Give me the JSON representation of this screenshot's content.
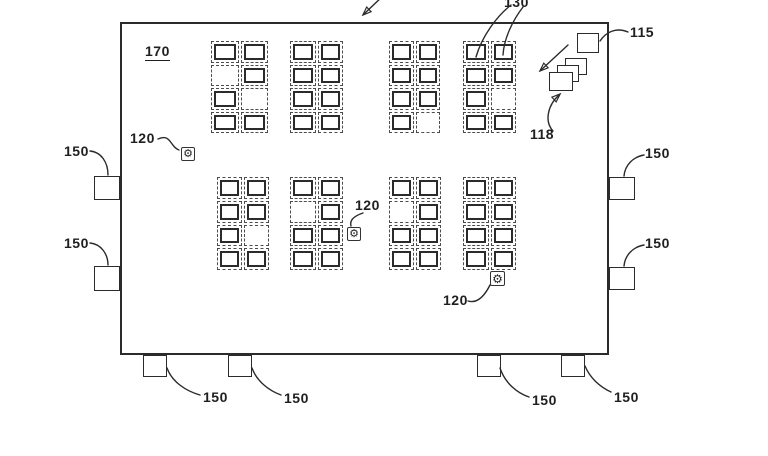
{
  "figure": {
    "width": 768,
    "height": 456,
    "bg": "#ffffff",
    "ink": "#2b2b2b"
  },
  "facility": {
    "label": "170",
    "x": 120,
    "y": 22,
    "w": 489,
    "h": 333,
    "label_x": 145,
    "label_y": 44
  },
  "storage_blocks": [
    {
      "x": 210,
      "y": 40,
      "w": 59,
      "h": 94,
      "pattern": [
        [
          1,
          1
        ],
        [
          0,
          1
        ],
        [
          1,
          0
        ],
        [
          1,
          1
        ]
      ]
    },
    {
      "x": 289,
      "y": 40,
      "w": 55,
      "h": 94,
      "pattern": [
        [
          1,
          1
        ],
        [
          1,
          1
        ],
        [
          1,
          1
        ],
        [
          1,
          1
        ]
      ]
    },
    {
      "x": 388,
      "y": 40,
      "w": 53,
      "h": 94,
      "pattern": [
        [
          1,
          1
        ],
        [
          1,
          1
        ],
        [
          1,
          1
        ],
        [
          1,
          0
        ]
      ]
    },
    {
      "x": 462,
      "y": 40,
      "w": 55,
      "h": 94,
      "pattern": [
        [
          1,
          1
        ],
        [
          1,
          1
        ],
        [
          1,
          0
        ],
        [
          1,
          1
        ]
      ]
    },
    {
      "x": 216,
      "y": 176,
      "w": 54,
      "h": 95,
      "pattern": [
        [
          1,
          1
        ],
        [
          1,
          1
        ],
        [
          1,
          0
        ],
        [
          1,
          1
        ]
      ]
    },
    {
      "x": 289,
      "y": 176,
      "w": 55,
      "h": 95,
      "pattern": [
        [
          1,
          1
        ],
        [
          0,
          1
        ],
        [
          1,
          1
        ],
        [
          1,
          1
        ]
      ]
    },
    {
      "x": 388,
      "y": 176,
      "w": 54,
      "h": 95,
      "pattern": [
        [
          1,
          1
        ],
        [
          0,
          1
        ],
        [
          1,
          1
        ],
        [
          1,
          1
        ]
      ]
    },
    {
      "x": 462,
      "y": 176,
      "w": 55,
      "h": 95,
      "pattern": [
        [
          1,
          1
        ],
        [
          1,
          1
        ],
        [
          1,
          1
        ],
        [
          1,
          1
        ]
      ]
    }
  ],
  "robots": [
    {
      "x": 181,
      "y": 147,
      "size": 14
    },
    {
      "x": 347,
      "y": 227,
      "size": 14
    },
    {
      "x": 490,
      "y": 271,
      "size": 15
    }
  ],
  "robot_glyph": "⚙",
  "doors": [
    {
      "x": 94,
      "y": 176,
      "w": 26,
      "h": 24
    },
    {
      "x": 94,
      "y": 266,
      "w": 26,
      "h": 25
    },
    {
      "x": 609,
      "y": 177,
      "w": 26,
      "h": 23
    },
    {
      "x": 609,
      "y": 267,
      "w": 26,
      "h": 23
    },
    {
      "x": 143,
      "y": 355,
      "w": 24,
      "h": 22
    },
    {
      "x": 228,
      "y": 355,
      "w": 24,
      "h": 22
    },
    {
      "x": 477,
      "y": 355,
      "w": 24,
      "h": 22
    },
    {
      "x": 561,
      "y": 355,
      "w": 24,
      "h": 22
    }
  ],
  "workstation": {
    "x": 577,
    "y": 33,
    "w": 22,
    "h": 20
  },
  "container_stack": [
    {
      "x": 565,
      "y": 58,
      "w": 22,
      "h": 17
    },
    {
      "x": 557,
      "y": 65,
      "w": 22,
      "h": 17
    },
    {
      "x": 549,
      "y": 72,
      "w": 24,
      "h": 19
    }
  ],
  "ref_labels": [
    {
      "id": "130",
      "text": "130",
      "x": 504,
      "y": -5
    },
    {
      "id": "115",
      "text": "115",
      "x": 630,
      "y": 25
    },
    {
      "id": "118",
      "text": "118",
      "x": 530,
      "y": 127
    },
    {
      "id": "120-1",
      "text": "120",
      "x": 130,
      "y": 131
    },
    {
      "id": "120-2",
      "text": "120",
      "x": 355,
      "y": 198
    },
    {
      "id": "120-3",
      "text": "120",
      "x": 443,
      "y": 293
    },
    {
      "id": "150-left-1",
      "text": "150",
      "x": 64,
      "y": 144
    },
    {
      "id": "150-left-2",
      "text": "150",
      "x": 64,
      "y": 236
    },
    {
      "id": "150-right-1",
      "text": "150",
      "x": 645,
      "y": 146
    },
    {
      "id": "150-right-2",
      "text": "150",
      "x": 645,
      "y": 236
    },
    {
      "id": "150-bottom-1",
      "text": "150",
      "x": 203,
      "y": 390
    },
    {
      "id": "150-bottom-2",
      "text": "150",
      "x": 284,
      "y": 391
    },
    {
      "id": "150-bottom-3",
      "text": "150",
      "x": 532,
      "y": 393
    },
    {
      "id": "150-bottom-4",
      "text": "150",
      "x": 614,
      "y": 390
    }
  ],
  "leader_lines": [
    {
      "id": "leader-130-a",
      "d": "M511,5 C497,16 482,36 476,57"
    },
    {
      "id": "leader-130-b",
      "d": "M523,7 C513,20 504,38 503,55"
    },
    {
      "id": "leader-115",
      "d": "M628,32 C616,27 606,32 600,41"
    },
    {
      "id": "leader-120-1",
      "d": "M158,139 C171,133 170,147 179,150"
    },
    {
      "id": "leader-120-2",
      "d": "M363,213 C357,215 349,219 351,226"
    },
    {
      "id": "leader-120-3",
      "d": "M468,301 C478,304 485,295 490,285"
    },
    {
      "id": "leader-150-l1",
      "d": "M90,151 C101,152 108,162 108,175"
    },
    {
      "id": "leader-150-l2",
      "d": "M90,243 C101,244 108,254 108,265"
    },
    {
      "id": "leader-150-r1",
      "d": "M644,155 C633,157 625,165 624,176"
    },
    {
      "id": "leader-150-r2",
      "d": "M644,245 C633,247 625,255 624,266"
    },
    {
      "id": "leader-150-b1",
      "d": "M167,368 C172,382 186,391 200,395"
    },
    {
      "id": "leader-150-b2",
      "d": "M252,368 C257,382 270,391 281,395"
    },
    {
      "id": "leader-150-b3",
      "d": "M500,368 C505,383 517,393 529,397"
    },
    {
      "id": "leader-150-b4",
      "d": "M585,366 C590,378 600,387 611,392"
    }
  ],
  "arrows": [
    {
      "id": "figure-pointer-arrow",
      "d": "M385,-6 L364,14"
    },
    {
      "id": "stack-pointer-arrow",
      "d": "M568,45 L541,70"
    },
    {
      "id": "leader-118-arrow",
      "d": "M553,131 C544,121 548,105 559,95"
    }
  ]
}
